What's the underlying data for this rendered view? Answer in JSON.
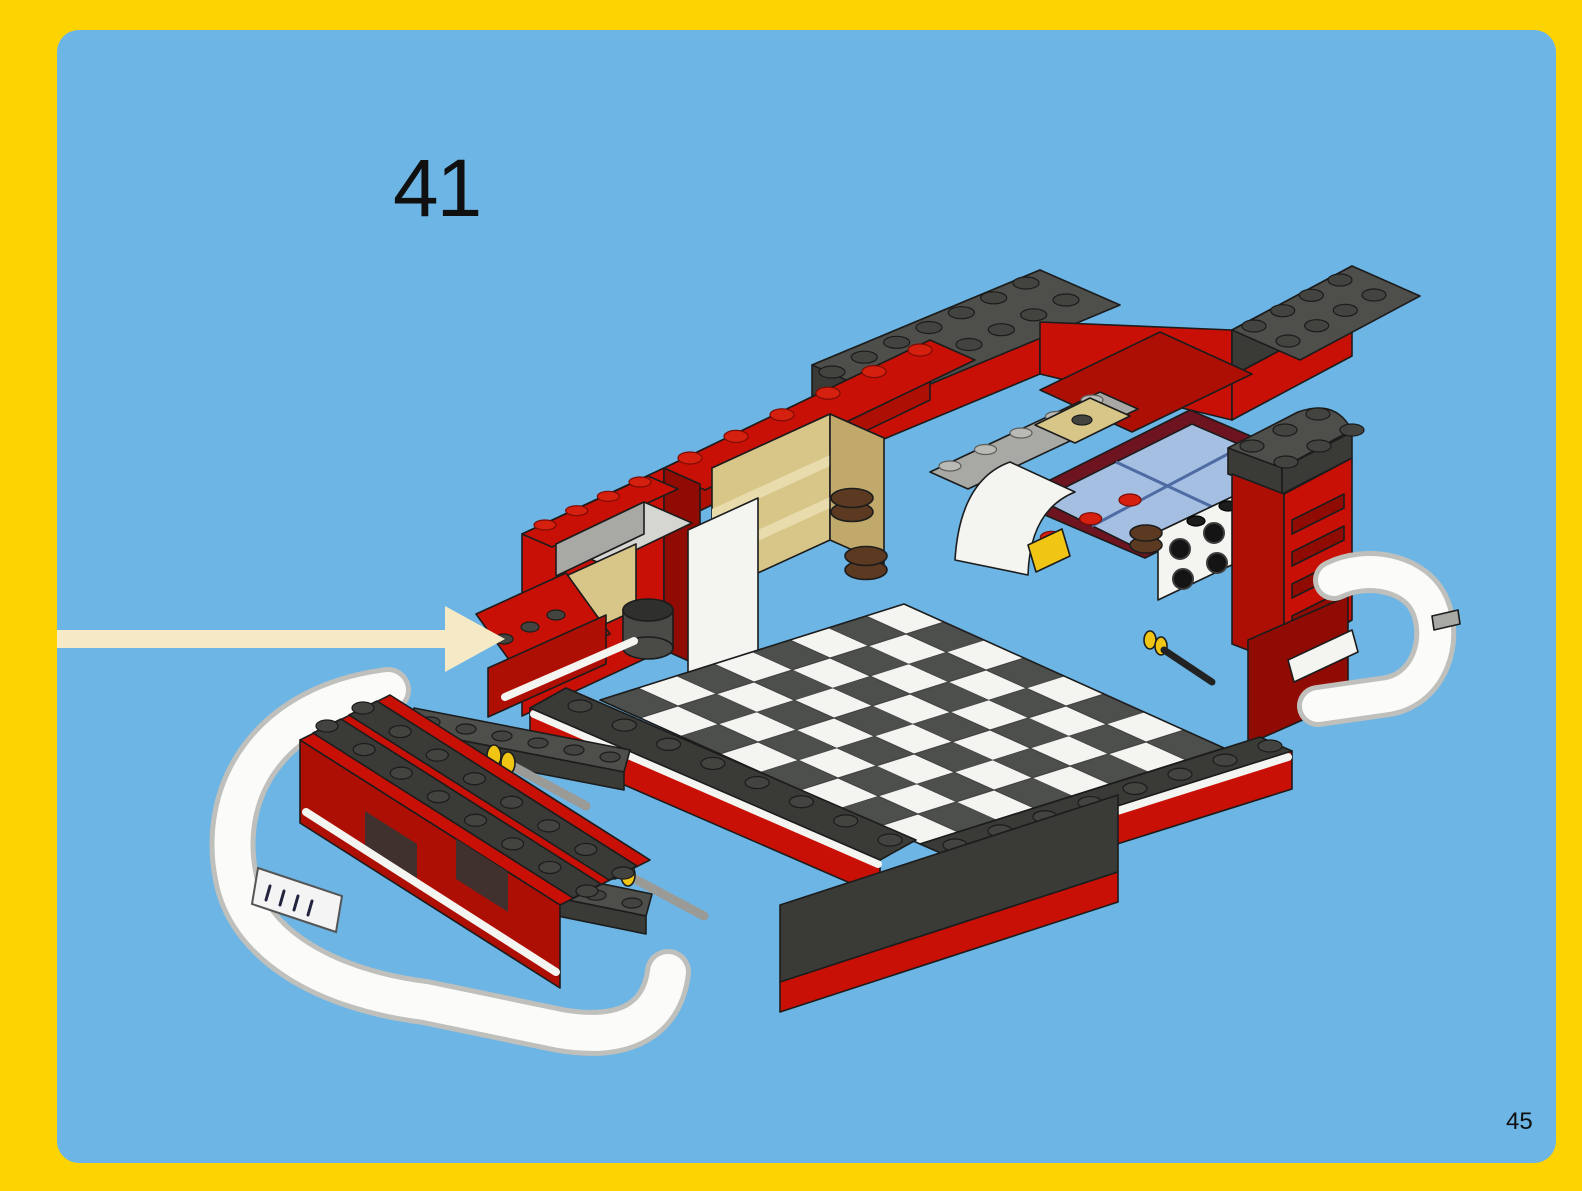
{
  "page": {
    "step_number": "41",
    "page_number": "45"
  },
  "colors": {
    "border-yellow": "#FDD301",
    "panel-blue": "#6CB5E5",
    "arrow-cream": "#F6E9C6",
    "lego-red": "#C81006",
    "lego-red-mid": "#AE0F05",
    "lego-red-dark": "#8F0B03",
    "dark-gray-top": "#4E4E4B",
    "dark-gray-side": "#3A3A37",
    "medium-gray": "#A8A8A5",
    "light-gray": "#D5D5D2",
    "white-piece": "#F4F4F1",
    "tan-light": "#E8DCAD",
    "tan": "#D8C689",
    "tan-dark": "#C0A96B",
    "brown": "#5C3A21",
    "window-blue": "#A5BFE3",
    "window-frame": "#6E1420",
    "axle-yellow": "#F0C514",
    "checker-dark": "#4C4F4C",
    "checker-white": "#F4F4F1",
    "outline": "#1C1C1C",
    "text-black": "#101010"
  }
}
